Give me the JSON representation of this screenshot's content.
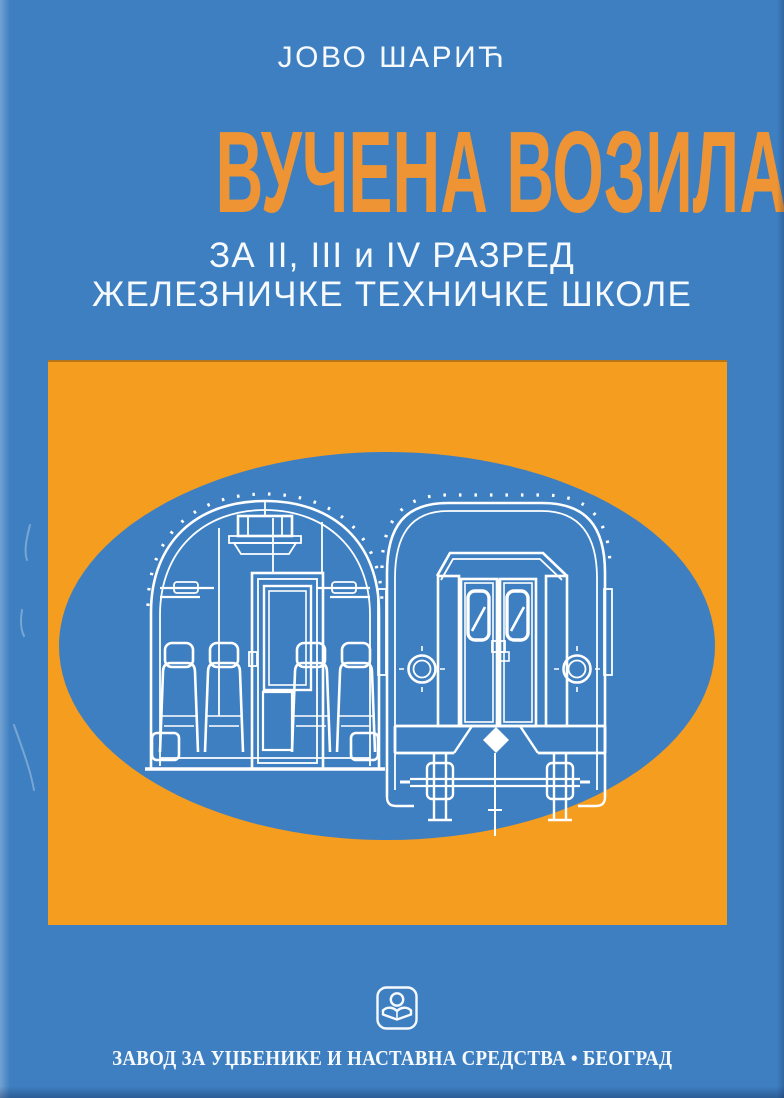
{
  "colors": {
    "background_blue": "#3e7fc1",
    "panel_orange": "#f59d1f",
    "title_orange": "#ee9434",
    "text_white": "#f7fafc",
    "line_white": "#ffffff"
  },
  "cover": {
    "author": "ЈОВО ШАРИЋ",
    "title": "ВУЧЕНА ВОЗИЛА",
    "subtitle_line1": "ЗА II, III и IV РАЗРЕД",
    "subtitle_line2": "ЖЕЛЕЗНИЧКЕ ТЕХНИЧКЕ ШКОЛЕ",
    "publisher_line": "ЗАВОД ЗА УЏБЕНИКЕ И НАСТАВНА СРЕДСТВА • БЕОГРАД"
  },
  "icons": {
    "publisher_logo": "open-book-with-reader-icon",
    "illustration_left": "passenger-carriage-interior-cross-section",
    "illustration_right": "passenger-carriage-end-view"
  }
}
